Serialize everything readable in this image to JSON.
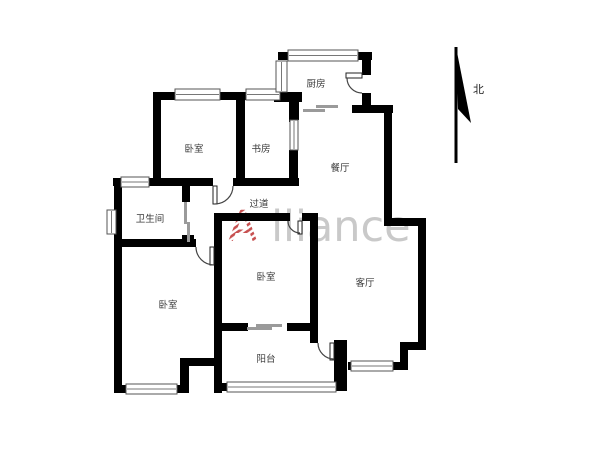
{
  "watermark": {
    "first_letter": "A",
    "rest": "lliance",
    "gray_color": "#c9c9c9",
    "accent_color": "#c75050"
  },
  "north_label": "北",
  "rooms": {
    "kitchen": "厨房",
    "bedroom_top": "卧室",
    "study": "书房",
    "dining": "餐厅",
    "bathroom": "卫生间",
    "hallway": "过道",
    "bedroom_middle": "卧室",
    "bedroom_left": "卧室",
    "living": "客厅",
    "balcony": "阳台"
  },
  "colors": {
    "wall": "#000000",
    "label": "#3a3a3a",
    "window_line": "#555555",
    "slider": "#9a9a9a",
    "background": "#ffffff"
  }
}
